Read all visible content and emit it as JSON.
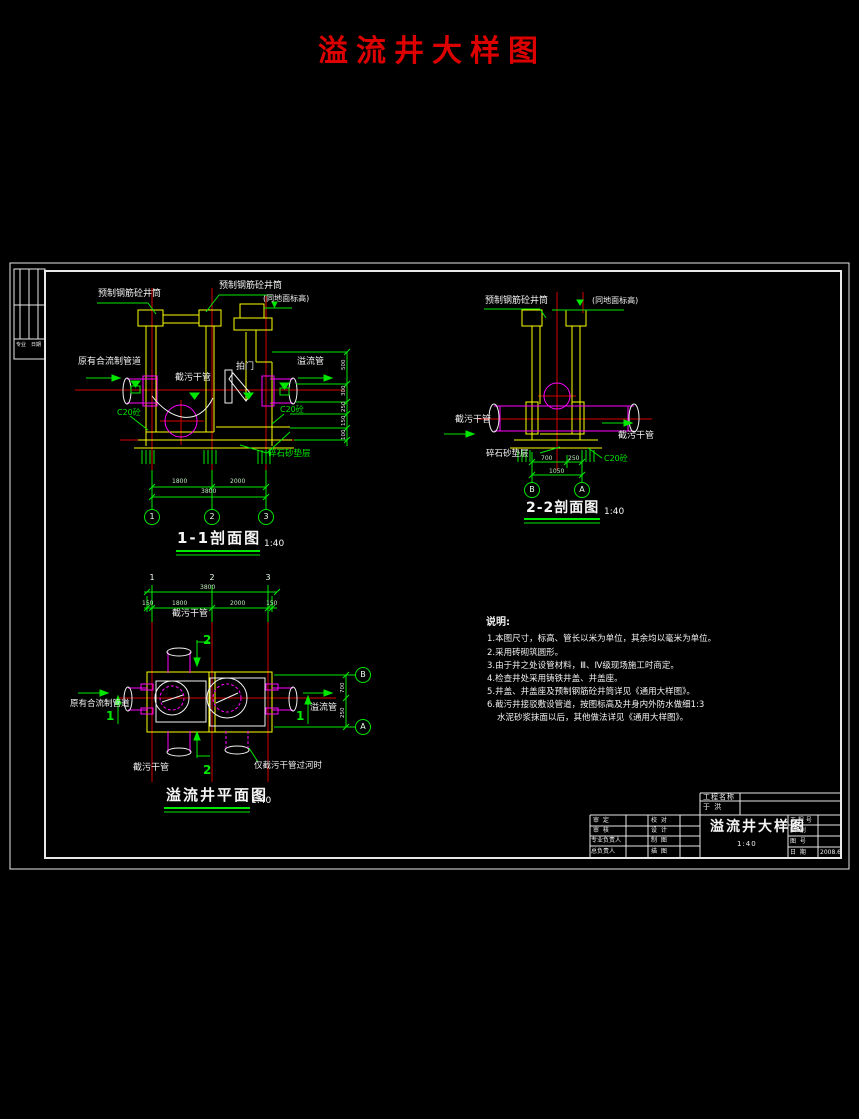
{
  "page_title": "溢流井大样图",
  "colors": {
    "accent_red": "#dd0000",
    "cad_green": "#00e800",
    "cad_yellow": "#ffff00",
    "cad_magenta": "#ff00ff",
    "cad_red": "#e60000",
    "cad_white": "#f2f2f2"
  },
  "sign_strip": {
    "c1": "专业",
    "c2": "日期"
  },
  "section_1_1": {
    "title": "1-1剖面图",
    "scale": "1:40",
    "labels": {
      "precast_shaft_left": "预制钢筋砼井筒",
      "precast_shaft_mid": "预制钢筋砼井筒",
      "ground_level": "(同地面标高)",
      "existing_pipe": "原有合流制管道",
      "intercept_pipe": "截污干管",
      "flap_gate": "拍门",
      "overflow_pipe": "溢流管",
      "c20_left": "C20砼",
      "c20_right": "C20砼",
      "gravel": "碎石砂垫层"
    },
    "dims": {
      "seg1": "1800",
      "seg2": "2000",
      "total": "3800"
    },
    "v_dims": [
      "500",
      "300",
      "250",
      "150",
      "100"
    ],
    "grid": [
      "1",
      "2",
      "3"
    ]
  },
  "section_2_2": {
    "title": "2-2剖面图",
    "scale": "1:40",
    "labels": {
      "precast_shaft": "预制钢筋砼井筒",
      "ground_level": "(同地面标高)",
      "intercept_left": "截污干管",
      "intercept_right": "截污干管",
      "gravel": "碎石砂垫层",
      "c20": "C20砼"
    },
    "dims": {
      "seg1": "700",
      "seg2": "250",
      "total": "1050"
    },
    "grid": [
      "B",
      "A"
    ]
  },
  "plan": {
    "title": "溢流井平面图",
    "scale": "1:40",
    "labels": {
      "intercept_top": "截污干管",
      "existing_pipe": "原有合流制管道",
      "overflow_pipe": "溢流管",
      "intercept_bottom": "截污干管",
      "note": "仅截污干管过河时"
    },
    "section_marks": {
      "s1": "1",
      "s2": "2"
    },
    "dims": {
      "total": "3800",
      "m1": "150",
      "seg1": "1800",
      "seg2": "2000",
      "m2": "150",
      "r1": "700",
      "r2": "250"
    },
    "grid_top": [
      "1",
      "2",
      "3"
    ],
    "grid_right": [
      "B",
      "A"
    ]
  },
  "notes": {
    "heading": "说明:",
    "lines": [
      "1.本图尺寸，标高、管长以米为单位，其余均以毫米为单位。",
      "2.采用砖砌筑圆形。",
      "3.由于井之处设管材料，Ⅲ、Ⅳ级现场施工时商定。",
      "4.检查井处采用铸铁井盖、井盖座。",
      "5.井盖、井盖座及预制钢筋砼井筒详见《通用大样图》。",
      "6.截污井接驳敷设管道，按图标高及井身内外防水做细1:3",
      "水泥砂浆抹面以后，其他做法详见《通用大样图》。"
    ]
  },
  "title_block": {
    "project_label": "工程名称",
    "project_value": "于  洪",
    "drawing_title": "溢流井大样图",
    "scale": "1:40",
    "left_rows": [
      {
        "l1": "审  定",
        "l2": "校  对"
      },
      {
        "l1": "审  核",
        "l2": "设  计"
      },
      {
        "l1": "专业负责人",
        "l2": "制  图"
      },
      {
        "l1": "总负责人",
        "l2": "描  图"
      }
    ],
    "right_rows": [
      {
        "label": "工 程 号",
        "value": ""
      },
      {
        "label": "图  别",
        "value": ""
      },
      {
        "label": "图  号",
        "value": ""
      },
      {
        "label": "日  期",
        "value": "2008.6"
      }
    ]
  }
}
